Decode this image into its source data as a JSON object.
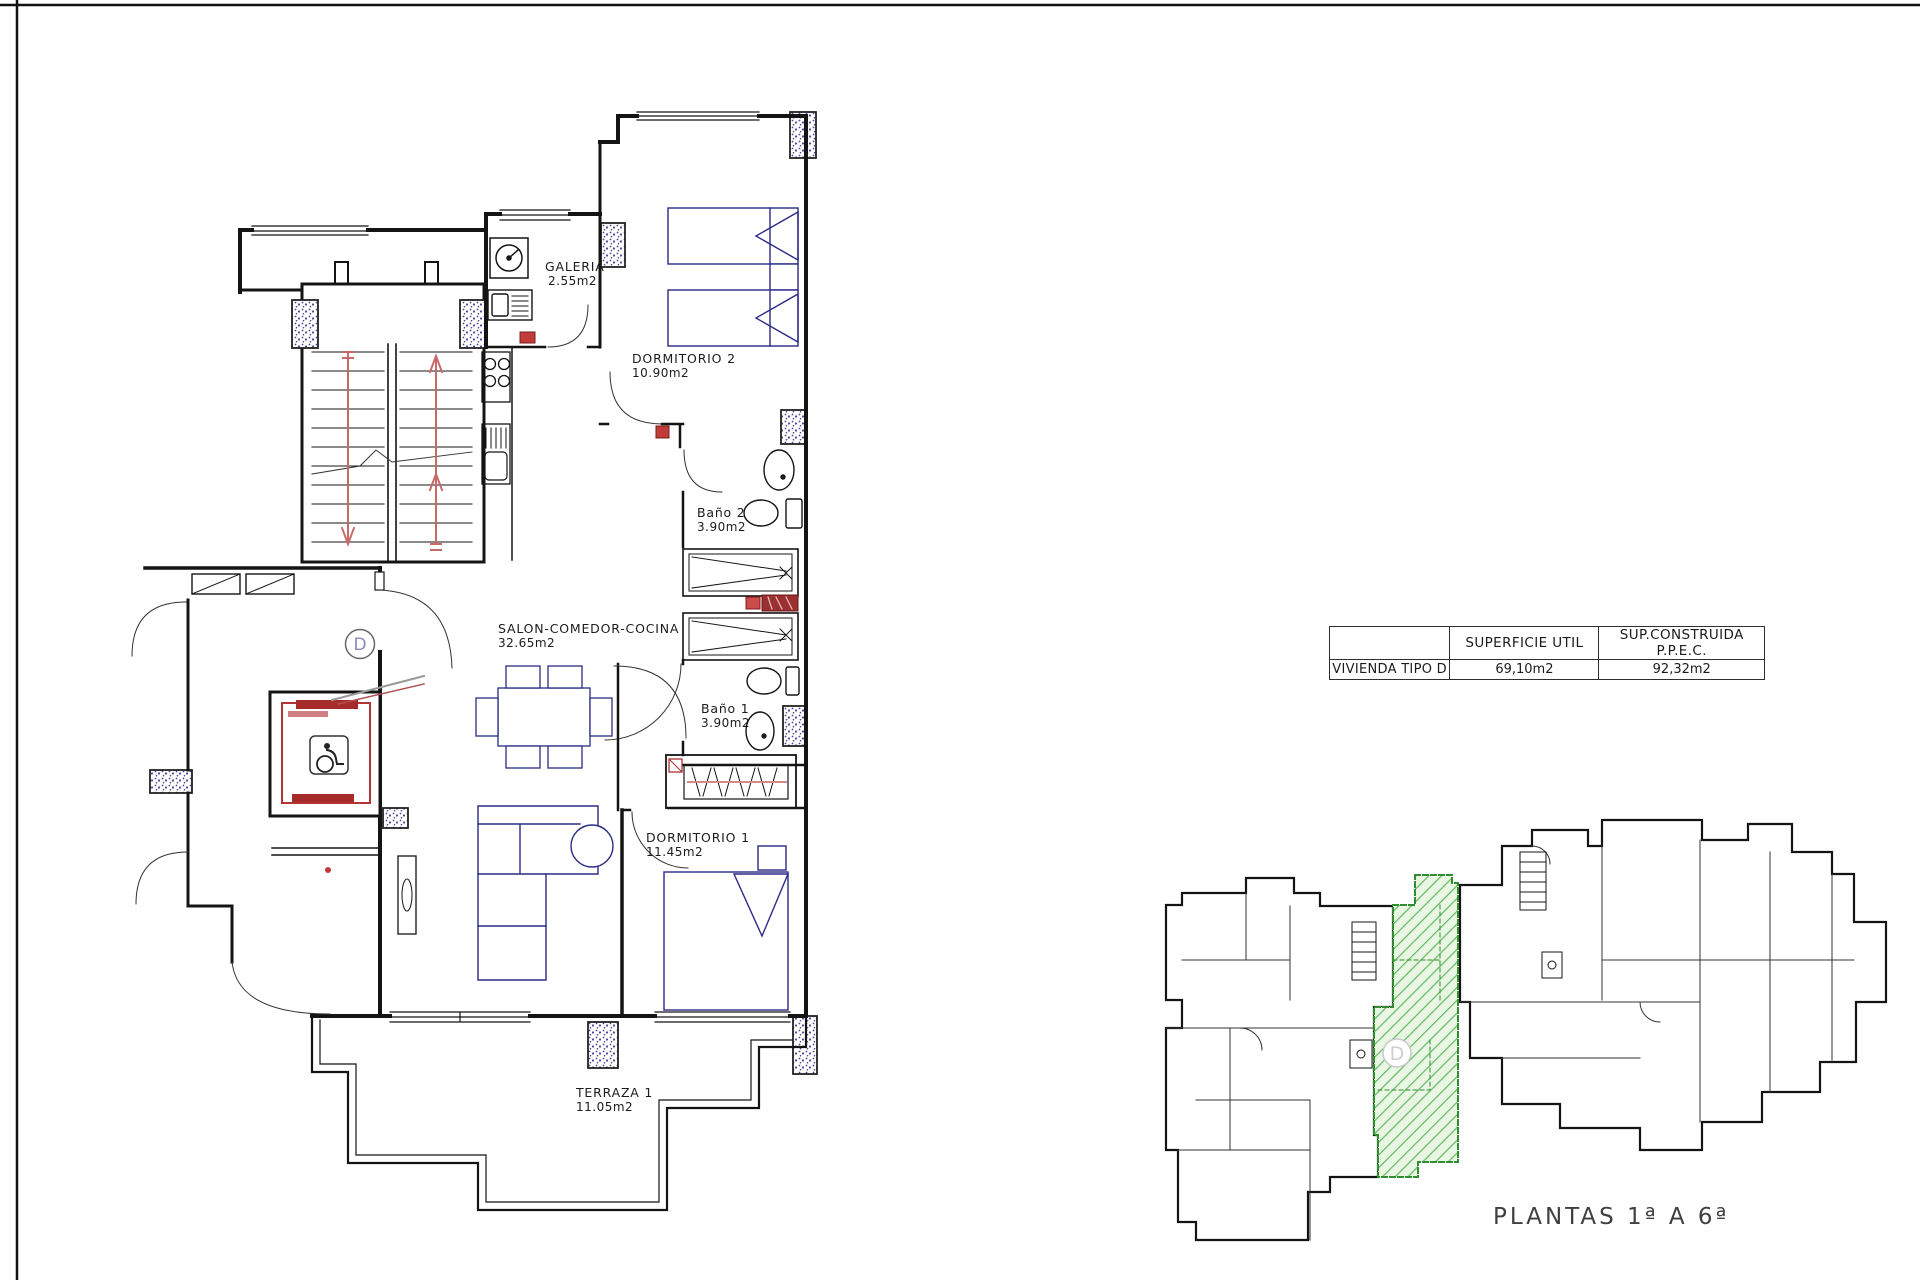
{
  "floor_plan": {
    "unit_letter": "D",
    "rooms": [
      {
        "name": "GALERIA",
        "area": "2.55m2"
      },
      {
        "name": "DORMITORIO 2",
        "area": "10.90m2"
      },
      {
        "name": "Baño 2",
        "area": "3.90m2"
      },
      {
        "name": "SALON-COMEDOR-COCINA",
        "area": "32.65m2"
      },
      {
        "name": "Baño 1",
        "area": "3.90m2"
      },
      {
        "name": "DORMITORIO 1",
        "area": "11.45m2"
      },
      {
        "name": "TERRAZA 1",
        "area": "11.05m2"
      }
    ]
  },
  "summary_table": {
    "row_label": "VIVIENDA TIPO D",
    "col_headers": [
      "SUPERFICIE UTIL",
      "SUP.CONSTRUIDA P.P.E.C."
    ],
    "superficie_util": "69,10m2",
    "sup_construida": "92,32m2"
  },
  "overview": {
    "caption": "PLANTAS 1ª A 6ª",
    "highlighted_unit": "D",
    "highlight_color": "#5cb85c"
  },
  "colors": {
    "wall": "#141414",
    "furniture": "#2b2b85",
    "stair_arrow": "#c96a6a",
    "elevator_red": "#a82b2b",
    "column_speckle": "#4a4a9a",
    "highlight_fill": "#e9f6e3"
  }
}
